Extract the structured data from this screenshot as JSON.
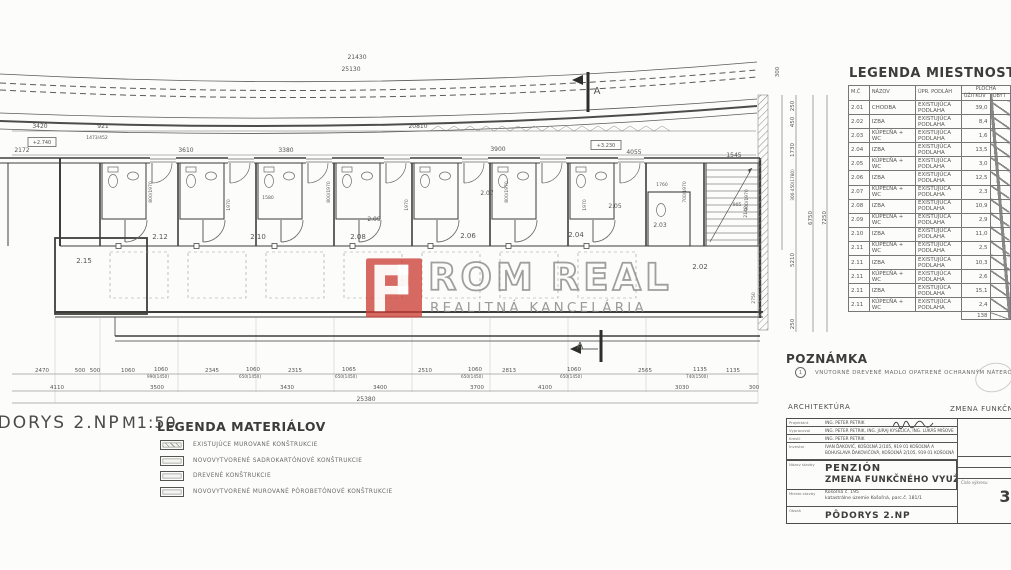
{
  "plan": {
    "scale_label": {
      "title": "PÔDORYS 2.NP",
      "scale": "M1:50"
    },
    "labels": [
      {
        "t": "21430",
        "x": 357,
        "y": 59
      },
      {
        "t": "25130",
        "x": 351,
        "y": 71
      },
      {
        "t": "20810",
        "x": 418,
        "y": 128
      },
      {
        "t": "3420",
        "x": 40,
        "y": 128
      },
      {
        "t": "921",
        "x": 103,
        "y": 128
      },
      {
        "t": "1473/452",
        "x": 97,
        "y": 139,
        "s": 4.5
      },
      {
        "t": "+2.740",
        "x": 42,
        "y": 144,
        "s": 5
      },
      {
        "t": "2172",
        "x": 22,
        "y": 152
      },
      {
        "t": "3610",
        "x": 186,
        "y": 152
      },
      {
        "t": "3380",
        "x": 286,
        "y": 152
      },
      {
        "t": "3900",
        "x": 498,
        "y": 151
      },
      {
        "t": "4055",
        "x": 634,
        "y": 154
      },
      {
        "t": "1545",
        "x": 734,
        "y": 157
      },
      {
        "t": "+3.230",
        "x": 606,
        "y": 147,
        "s": 5
      },
      {
        "t": "A",
        "x": 597,
        "y": 94,
        "s": 10
      },
      {
        "t": "A",
        "x": 580,
        "y": 349,
        "s": 10
      },
      {
        "t": "2.15",
        "x": 84,
        "y": 263,
        "s": 7
      },
      {
        "t": "2.12",
        "x": 160,
        "y": 239,
        "s": 7
      },
      {
        "t": "2.10",
        "x": 258,
        "y": 239,
        "s": 7
      },
      {
        "t": "2.08",
        "x": 358,
        "y": 239,
        "s": 7
      },
      {
        "t": "2.06",
        "x": 468,
        "y": 238,
        "s": 7
      },
      {
        "t": "2.04",
        "x": 576,
        "y": 237,
        "s": 7
      },
      {
        "t": "2.02",
        "x": 700,
        "y": 269,
        "s": 7
      },
      {
        "t": "2.07",
        "x": 487,
        "y": 195,
        "s": 6
      },
      {
        "t": "2.05",
        "x": 615,
        "y": 208,
        "s": 6
      },
      {
        "t": "2.09",
        "x": 374,
        "y": 221,
        "s": 6
      },
      {
        "t": "2.03",
        "x": 660,
        "y": 227,
        "s": 6
      },
      {
        "t": "800/1970",
        "x": 152,
        "y": 192,
        "r": -90,
        "s": 4.5
      },
      {
        "t": "1970",
        "x": 230,
        "y": 205,
        "r": -90,
        "s": 4.5
      },
      {
        "t": "800/1970",
        "x": 330,
        "y": 192,
        "r": -90,
        "s": 4.5
      },
      {
        "t": "1970",
        "x": 408,
        "y": 205,
        "r": -90,
        "s": 4.5
      },
      {
        "t": "800/1970",
        "x": 508,
        "y": 192,
        "r": -90,
        "s": 4.5
      },
      {
        "t": "1970",
        "x": 586,
        "y": 205,
        "r": -90,
        "s": 4.5
      },
      {
        "t": "700/1970",
        "x": 686,
        "y": 192,
        "r": -90,
        "s": 4.5
      },
      {
        "t": "900/1970",
        "x": 748,
        "y": 200,
        "r": -90,
        "s": 4.5
      },
      {
        "t": "1580",
        "x": 268,
        "y": 199,
        "s": 4.5
      },
      {
        "t": "1760",
        "x": 662,
        "y": 186,
        "s": 4.5
      },
      {
        "t": "905",
        "x": 737,
        "y": 206,
        "s": 4.5
      },
      {
        "t": "2470",
        "x": 42,
        "y": 372,
        "s": 5.5
      },
      {
        "t": "500",
        "x": 80,
        "y": 372,
        "s": 5.5
      },
      {
        "t": "500",
        "x": 95,
        "y": 372,
        "s": 5.5
      },
      {
        "t": "1060",
        "x": 128,
        "y": 372,
        "s": 5.5
      },
      {
        "t": "1060",
        "x": 161,
        "y": 371,
        "s": 5.5
      },
      {
        "t": "990(1450)",
        "x": 158,
        "y": 378,
        "s": 4.2
      },
      {
        "t": "2345",
        "x": 212,
        "y": 372,
        "s": 5.5
      },
      {
        "t": "1060",
        "x": 253,
        "y": 371,
        "s": 5.5
      },
      {
        "t": "650(1450)",
        "x": 250,
        "y": 378,
        "s": 4.2
      },
      {
        "t": "2315",
        "x": 295,
        "y": 372,
        "s": 5.5
      },
      {
        "t": "1065",
        "x": 349,
        "y": 371,
        "s": 5.5
      },
      {
        "t": "650(1450)",
        "x": 346,
        "y": 378,
        "s": 4.2
      },
      {
        "t": "2510",
        "x": 425,
        "y": 372,
        "s": 5.5
      },
      {
        "t": "1060",
        "x": 475,
        "y": 371,
        "s": 5.5
      },
      {
        "t": "650(1450)",
        "x": 472,
        "y": 378,
        "s": 4.2
      },
      {
        "t": "2813",
        "x": 509,
        "y": 372,
        "s": 5.5
      },
      {
        "t": "1060",
        "x": 574,
        "y": 371,
        "s": 5.5
      },
      {
        "t": "650(1450)",
        "x": 571,
        "y": 378,
        "s": 4.2
      },
      {
        "t": "2565",
        "x": 645,
        "y": 372,
        "s": 5.5
      },
      {
        "t": "1135",
        "x": 700,
        "y": 371,
        "s": 5.5
      },
      {
        "t": "740(1500)",
        "x": 697,
        "y": 378,
        "s": 4.2
      },
      {
        "t": "1135",
        "x": 733,
        "y": 372,
        "s": 5.5
      },
      {
        "t": "4110",
        "x": 57,
        "y": 389,
        "s": 5.5
      },
      {
        "t": "3500",
        "x": 157,
        "y": 389,
        "s": 5.5
      },
      {
        "t": "3430",
        "x": 287,
        "y": 389,
        "s": 5.5
      },
      {
        "t": "3400",
        "x": 380,
        "y": 389,
        "s": 5.5
      },
      {
        "t": "3700",
        "x": 477,
        "y": 389,
        "s": 5.5
      },
      {
        "t": "4100",
        "x": 545,
        "y": 389,
        "s": 5.5
      },
      {
        "t": "3030",
        "x": 682,
        "y": 389,
        "s": 5.5
      },
      {
        "t": "300",
        "x": 754,
        "y": 389,
        "s": 5.5
      },
      {
        "t": "25380",
        "x": 366,
        "y": 401,
        "s": 6
      },
      {
        "t": "300",
        "x": 779,
        "y": 72,
        "r": -90,
        "s": 5.5
      },
      {
        "t": "250",
        "x": 794,
        "y": 106,
        "r": -90,
        "s": 5.5
      },
      {
        "t": "450",
        "x": 794,
        "y": 122,
        "r": -90,
        "s": 5.5
      },
      {
        "t": "1730",
        "x": 794,
        "y": 150,
        "r": -90,
        "s": 5.5
      },
      {
        "t": "300-450(1780)",
        "x": 794,
        "y": 185,
        "r": -90,
        "s": 4.2
      },
      {
        "t": "5210",
        "x": 794,
        "y": 260,
        "r": -90,
        "s": 5.5
      },
      {
        "t": "250",
        "x": 794,
        "y": 324,
        "r": -90,
        "s": 5.5
      },
      {
        "t": "6750",
        "x": 812,
        "y": 218,
        "r": -90,
        "s": 5.5
      },
      {
        "t": "7250",
        "x": 826,
        "y": 218,
        "r": -90,
        "s": 5.5
      },
      {
        "t": "2750",
        "x": 755,
        "y": 298,
        "r": -90,
        "s": 4.5
      },
      {
        "t": "2140",
        "x": 747,
        "y": 212,
        "r": -90,
        "s": 4.5
      }
    ]
  },
  "watermark": {
    "letters_left": "ROM",
    "letters_right": "REAL",
    "subtitle": "REALITNÁ KANCELÁRIA",
    "red": "#cc4138"
  },
  "legend_rooms": {
    "title": "LEGENDA MIESTNOSTÍ",
    "headers": {
      "mc": "M.Č",
      "nazov": "NÁZOV",
      "upr": "ÚPR. PODLÁH",
      "plocha": "PLOCHA",
      "uzitkov": "ÚŽITKOV",
      "obyt": "OBYT"
    },
    "rows": [
      {
        "mc": "2.01",
        "nazov": "CHODBA",
        "upr": "EXISTUJÚCA PODLAHA",
        "plocha": "39,0"
      },
      {
        "mc": "2.02",
        "nazov": "IZBA",
        "upr": "EXISTUJÚCA PODLAHA",
        "plocha": "8,4"
      },
      {
        "mc": "2.03",
        "nazov": "KÚPEĽŇA + WC",
        "upr": "EXISTUJÚCA PODLAHA",
        "plocha": "1,6"
      },
      {
        "mc": "2.04",
        "nazov": "IZBA",
        "upr": "EXISTUJÚCA PODLAHA",
        "plocha": "13,5"
      },
      {
        "mc": "2.05",
        "nazov": "KÚPEĽŇA + WC",
        "upr": "EXISTUJÚCA PODLAHA",
        "plocha": "3,0"
      },
      {
        "mc": "2.06",
        "nazov": "IZBA",
        "upr": "EXISTUJÚCA PODLAHA",
        "plocha": "12,5"
      },
      {
        "mc": "2.07",
        "nazov": "KÚPEĽŇA + WC",
        "upr": "EXISTUJÚCA PODLAHA",
        "plocha": "2,3"
      },
      {
        "mc": "2.08",
        "nazov": "IZBA",
        "upr": "EXISTUJÚCA PODLAHA",
        "plocha": "10,9"
      },
      {
        "mc": "2.09",
        "nazov": "KÚPEĽŇA + WC",
        "upr": "EXISTUJÚCA PODLAHA",
        "plocha": "2,9"
      },
      {
        "mc": "2.10",
        "nazov": "IZBA",
        "upr": "EXISTUJÚCA PODLAHA",
        "plocha": "11,0"
      },
      {
        "mc": "2.11",
        "nazov": "KÚPEĽŇA + WC",
        "upr": "EXISTUJÚCA PODLAHA",
        "plocha": "2,5"
      },
      {
        "mc": "2.11",
        "nazov": "IZBA",
        "upr": "EXISTUJÚCA PODLAHA",
        "plocha": "10,3"
      },
      {
        "mc": "2.11",
        "nazov": "KÚPEĽŇA + WC",
        "upr": "EXISTUJÚCA PODLAHA",
        "plocha": "2,6"
      },
      {
        "mc": "2.11",
        "nazov": "IZBA",
        "upr": "EXISTUJÚCA PODLAHA",
        "plocha": "15,1"
      },
      {
        "mc": "2.11",
        "nazov": "KÚPEĽŇA + WC",
        "upr": "EXISTUJÚCA PODLAHA",
        "plocha": "2,4"
      }
    ],
    "total": "138"
  },
  "poznamka": {
    "title": "POZNÁMKA",
    "marker": "1",
    "text": "VNÚTORNÉ DREVENÉ MADLO OPATRENÉ OCHRANNÝM NÁTEROM"
  },
  "legend_materials": {
    "title": "LEGENDA MATERIÁLOV",
    "items": [
      {
        "label": "EXISTUJÚCE MUROVANÉ KONŠTRUKCIE",
        "swatch": "hatch"
      },
      {
        "label": "NOVOVYTVORENÉ SADROKARTÓNOVÉ KONŠTRUKCIE",
        "swatch": "plain"
      },
      {
        "label": "DREVENÉ KONŠTRUKCIE",
        "swatch": "plain"
      },
      {
        "label": "NOVOVYTVORENÉ MUROVANÉ PÓROBETÓNOVÉ KONŠTRUKCIE",
        "swatch": "plain"
      }
    ]
  },
  "title_block": {
    "section_left": "ARCHITEKTÚRA",
    "section_right": "ZMENA FUNKČNÉHO V",
    "rows": {
      "projektant_label": "Projektant",
      "projektant": "ING. PETER PETRIK",
      "vypracoval_label": "Vypracoval",
      "vypracoval": "ING. PETER PETRIK, ING. JURAJ KYSELICA, ING. LUKÁŠ MIŠOVE",
      "kreslil_label": "Kreslil",
      "kreslil": "ING. PETER PETRIK",
      "investor_label": "Investor",
      "investor1": "IVAN ĎAKOVIČ, KOŠOĽNÁ 2/105, 919 01 KOŠOĽNÁ A",
      "investor2": "BOHUSLAVA ĎAKOVIČOVÁ, KOŠOĽNÁ 2/105, 919 01 KOŠOĽNÁ",
      "nazov_label": "Názov stavby",
      "nazov1": "PENZIÓN",
      "nazov2": "ZMENA FUNKČNÉHO VYUŽITIA STAVBY",
      "miesto_label": "Miesto stavby",
      "miesto1": "Košoľná č. 195",
      "miesto2": "katastrálne územie Košoľná, parc.č. 181/1",
      "obsah_label": "Obsah",
      "obsah": "PÔDORYS 2.NP"
    },
    "right": {
      "datum_label": "Dátum",
      "datum": "09/20",
      "zakazka_label": "Zákazka č.",
      "cislo_label": "Číslo výkresu",
      "cislo": "3"
    }
  }
}
